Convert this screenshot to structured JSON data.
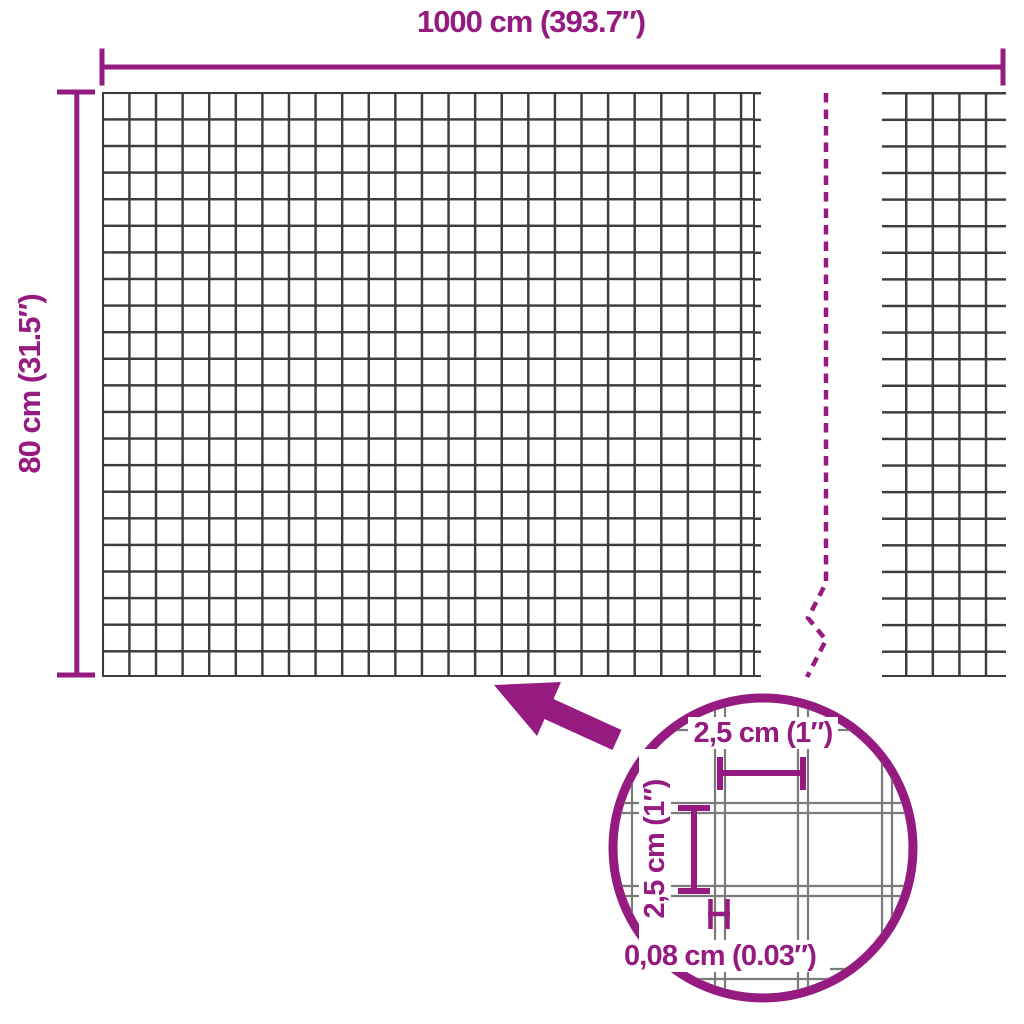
{
  "diagram": {
    "width_label": "1000 cm (393.7″)",
    "height_label": "80 cm (31.5″)",
    "detail": {
      "cell_width_label": "2,5 cm (1″)",
      "cell_height_label": "2,5 cm (1″)",
      "wire_thickness_label": "0,08 cm (0.03″)"
    },
    "colors": {
      "accent": "#951b81",
      "mesh_line": "#3d3d3d",
      "detail_wire": "#7a7a7a",
      "background": "#ffffff"
    },
    "icons": {
      "zoom_arrow": "arrow-up-left",
      "detail_circle": "magnifier-circle",
      "break_line": "dashed-break-zigzag"
    }
  }
}
